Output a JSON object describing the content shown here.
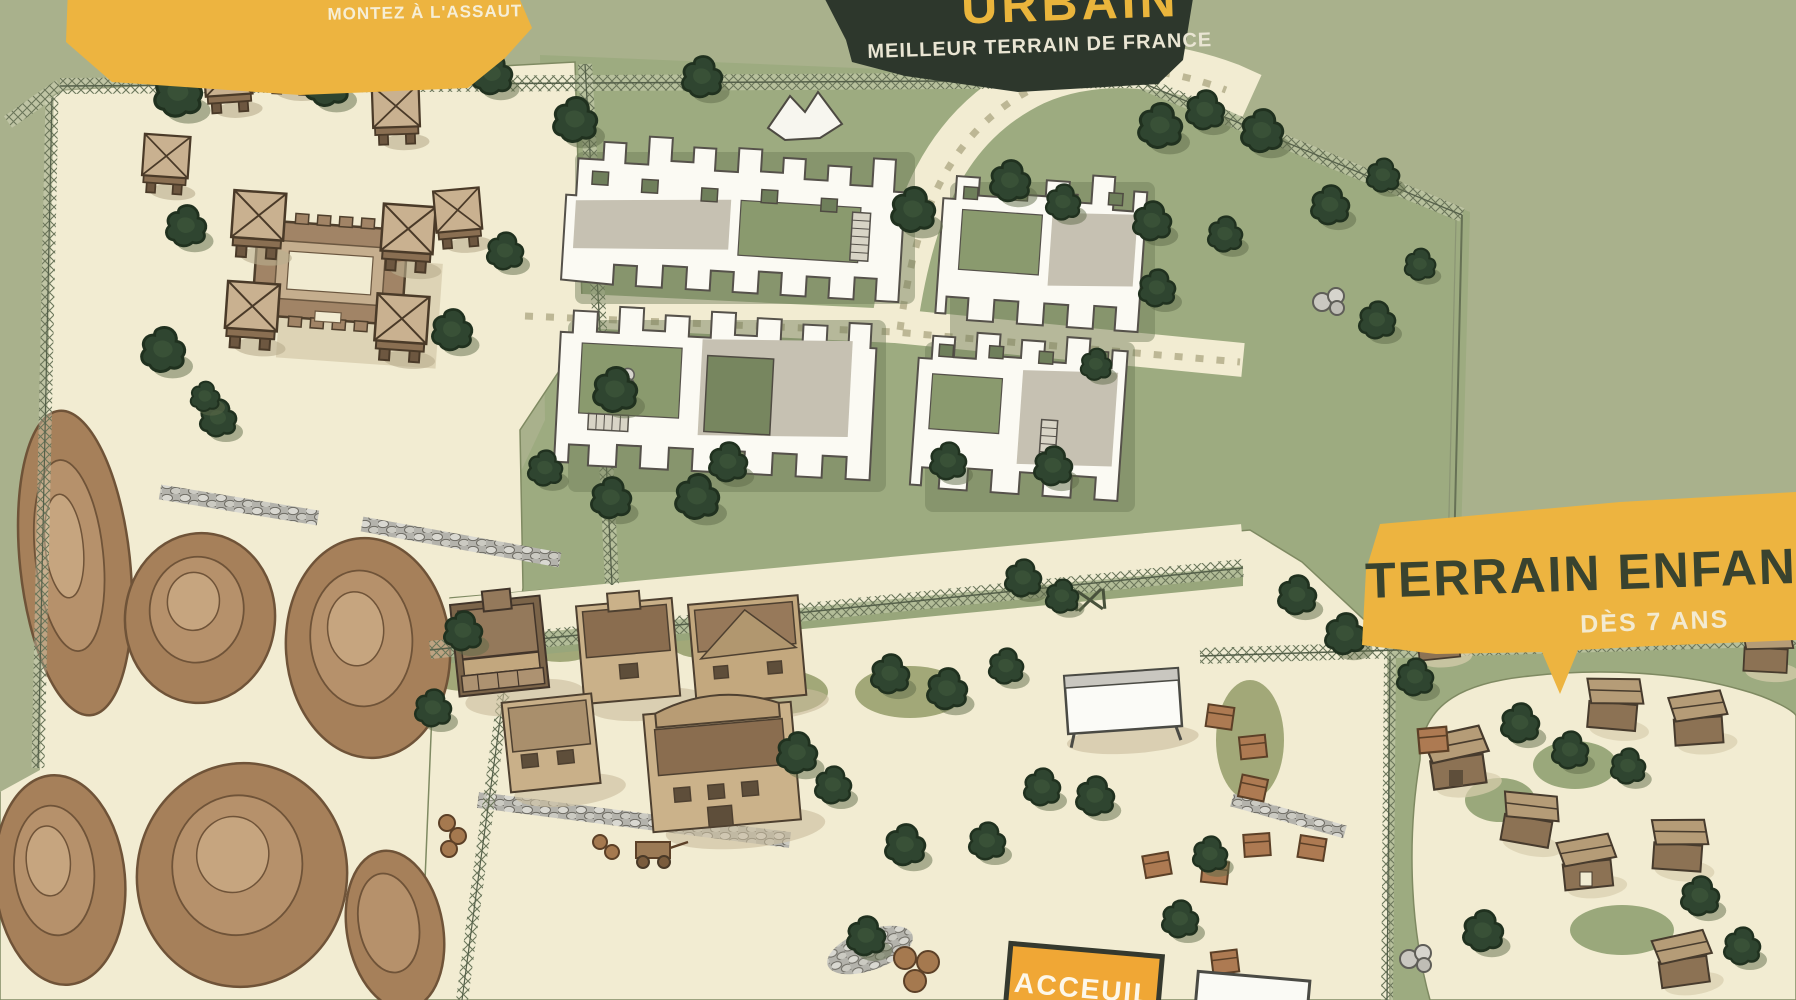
{
  "banners": {
    "assault": {
      "label": "MONTEZ À L'ASSAUT"
    },
    "main": {
      "title": "URBAIN",
      "subtitle": "MEILLEUR TERRAIN DE FRANCE"
    },
    "kids": {
      "title": "TERRAIN ENFANT",
      "subtitle": "DÈS 7 ANS"
    },
    "reception": {
      "label": "ACCEUIL"
    }
  },
  "colors": {
    "outside_green": "#a9b18c",
    "grass_green": "#9dab80",
    "ground_cream": "#f2ecd2",
    "dirt_brown": "#a6805a",
    "tree_green": "#2f4530",
    "ruin_white": "#fbfaf3",
    "wood_brown": "#8a6d4f",
    "banner_yellow": "#edb440",
    "banner_dark": "#2d372c",
    "sign_orange": "#f0a735",
    "text_cream": "#f3ead0",
    "text_dark": "#3a4430"
  }
}
